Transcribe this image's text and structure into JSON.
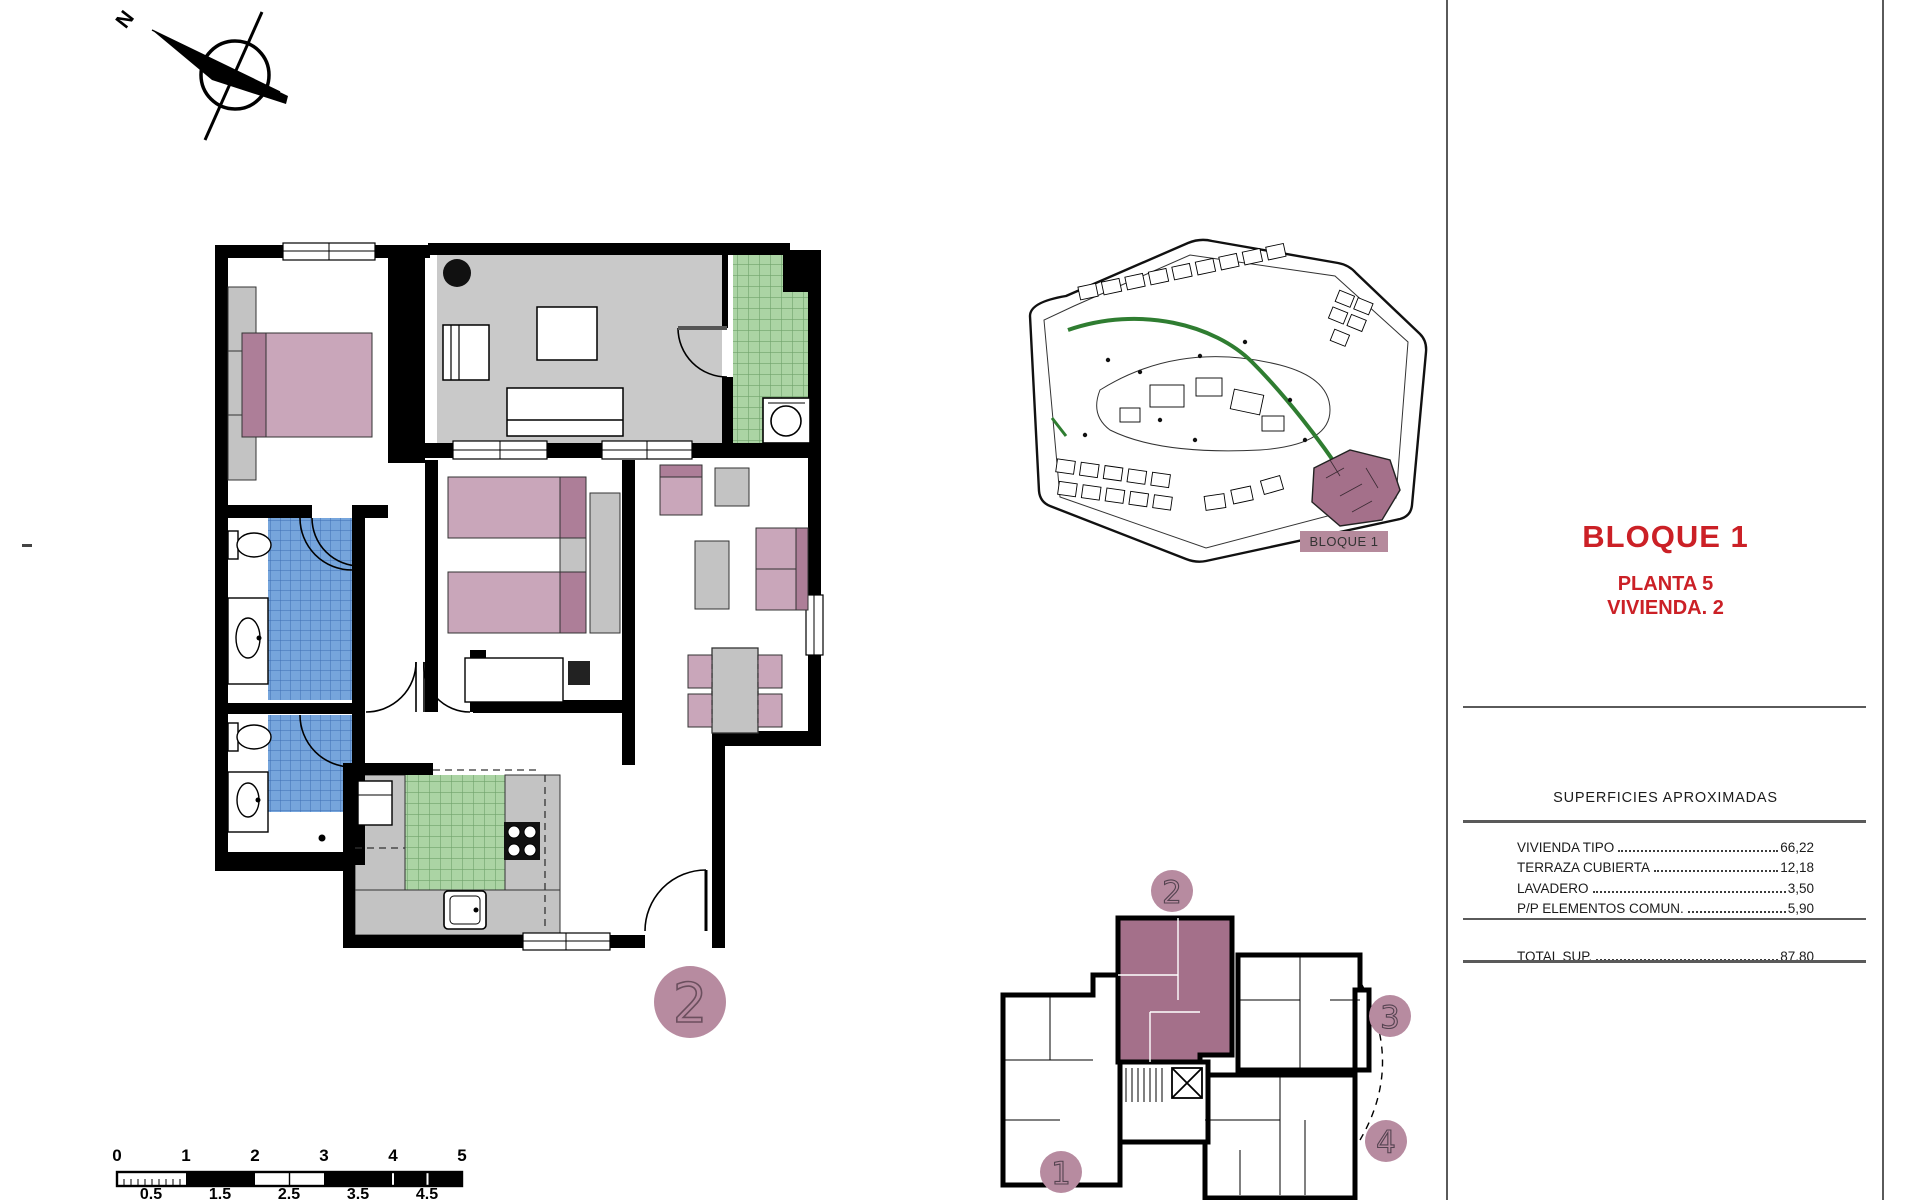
{
  "colors": {
    "accent_red": "#cb2026",
    "mauve_light": "#c9a6ba",
    "mauve_dark": "#ad7e98",
    "rose_badge": "#b78ba0",
    "unit_highlight": "#a4708a",
    "label_bg": "#b58a9c",
    "tile_blue": "#76a5dc",
    "tile_green": "#abd4a4",
    "terrace_gray": "#c9c9c9",
    "counter_gray": "#c3c3c3",
    "site_green": "#2f7d31"
  },
  "compass": {
    "north_label": "N"
  },
  "main_plan": {
    "unit_badge": "2"
  },
  "site_plan": {
    "block_label": "BLOQUE 1"
  },
  "title_block": {
    "title": "BLOQUE 1",
    "floor_line": "PLANTA 5",
    "unit_line": "VIVIENDA. 2"
  },
  "areas_table": {
    "header": "SUPERFICIES APROXIMADAS",
    "rows": [
      {
        "label": "VIVIENDA TIPO",
        "value": "66,22"
      },
      {
        "label": "TERRAZA CUBIERTA",
        "value": "12,18"
      },
      {
        "label": "LAVADERO",
        "value": "3,50"
      },
      {
        "label": "P/P ELEMENTOS COMUN.",
        "value": "5,90"
      }
    ],
    "total": {
      "label": "TOTAL SUP.",
      "value": "87,80"
    }
  },
  "key_plan": {
    "unit_labels": [
      "1",
      "2",
      "3",
      "4"
    ],
    "highlighted_unit": "2"
  },
  "scale_bar": {
    "major_labels": [
      "0",
      "1",
      "2",
      "3",
      "4",
      "5"
    ],
    "mid_labels": [
      "0.5",
      "1.5",
      "2.5",
      "3.5",
      "4.5"
    ]
  }
}
